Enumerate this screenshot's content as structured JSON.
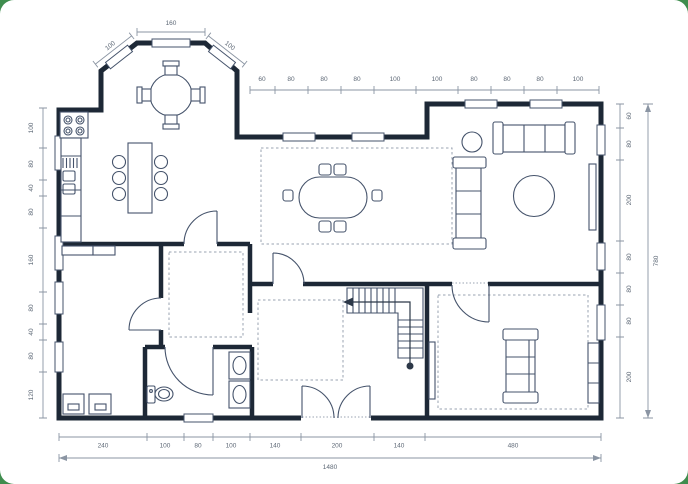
{
  "colors": {
    "canvas-bg": "#3f8d4e",
    "card": "#ffffff",
    "wall": "#1d2836",
    "furniture": "#45536b",
    "dimension-line": "#8b95a3",
    "dimension-text": "#5d6876",
    "dashed": "#99a3b2",
    "guide": "#2c3848"
  },
  "dimensions": {
    "bay": {
      "top": "160",
      "left": "100",
      "right": "100"
    },
    "top": [
      "60",
      "80",
      "80",
      "80",
      "100",
      "100",
      "80",
      "80",
      "80",
      "100"
    ],
    "left": [
      "100",
      "80",
      "40",
      "80",
      "160",
      "80",
      "40",
      "80",
      "120"
    ],
    "right": [
      "60",
      "80",
      "200",
      "80",
      "80",
      "80",
      "200"
    ],
    "right_total": "780",
    "bottom": [
      "240",
      "100",
      "80",
      "100",
      "140",
      "200",
      "140",
      "480"
    ],
    "bottom_total": "1480"
  }
}
